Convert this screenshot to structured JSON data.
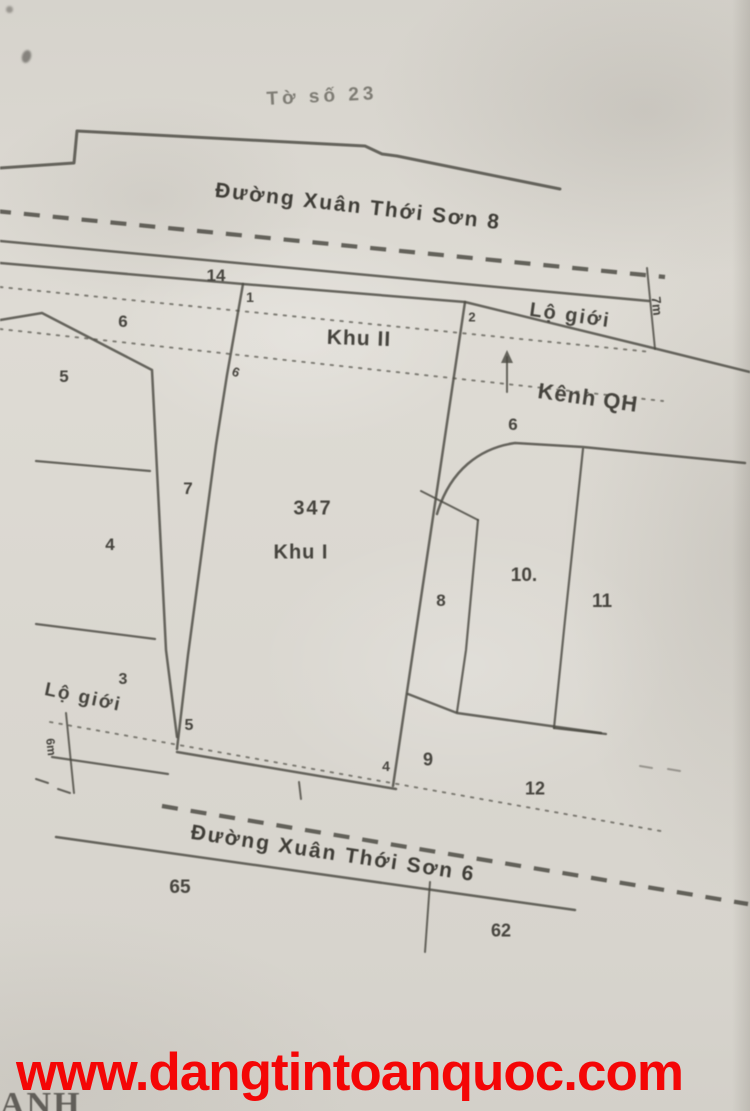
{
  "document": {
    "sheet_title": "Tờ số 23",
    "watermark_url": "www.dangtintoanquoc.com",
    "corner_text": "ANH"
  },
  "roads": {
    "top_road": "Đường Xuân Thới Sơn 8",
    "bottom_road": "Đường Xuân Thới Sơn 6"
  },
  "zones": {
    "zone1_label": "Khu I",
    "zone2_label": "Khu II",
    "parcel_number": "347",
    "canal_label": "Kênh QH"
  },
  "road_boundary": {
    "top_label": "Lộ giới",
    "top_width": "7m",
    "bottom_label": "Lộ giới",
    "bottom_width": "6m"
  },
  "plot_labels": [
    {
      "text": "14",
      "x": 216,
      "y": 276,
      "size": 17
    },
    {
      "text": "1",
      "x": 250,
      "y": 297,
      "size": 14
    },
    {
      "text": "2",
      "x": 472,
      "y": 317,
      "size": 13
    },
    {
      "text": "6",
      "x": 123,
      "y": 322,
      "size": 17
    },
    {
      "text": "5",
      "x": 64,
      "y": 377,
      "size": 17
    },
    {
      "text": "6",
      "x": 236,
      "y": 372,
      "size": 13,
      "rot": 20
    },
    {
      "text": "7",
      "x": 188,
      "y": 489,
      "size": 17
    },
    {
      "text": "4",
      "x": 110,
      "y": 545,
      "size": 17
    },
    {
      "text": "6",
      "x": 513,
      "y": 425,
      "size": 17
    },
    {
      "text": "8",
      "x": 441,
      "y": 601,
      "size": 17
    },
    {
      "text": "10.",
      "x": 524,
      "y": 576,
      "size": 19
    },
    {
      "text": "11",
      "x": 602,
      "y": 602,
      "size": 19
    },
    {
      "text": "3",
      "x": 123,
      "y": 680,
      "size": 16
    },
    {
      "text": "5",
      "x": 189,
      "y": 726,
      "size": 16
    },
    {
      "text": "4",
      "x": 386,
      "y": 766,
      "size": 14
    },
    {
      "text": "9",
      "x": 428,
      "y": 760,
      "size": 18
    },
    {
      "text": "12",
      "x": 535,
      "y": 789,
      "size": 18
    },
    {
      "text": "65",
      "x": 180,
      "y": 888,
      "size": 19
    },
    {
      "text": "62",
      "x": 501,
      "y": 931,
      "size": 18
    }
  ]
}
